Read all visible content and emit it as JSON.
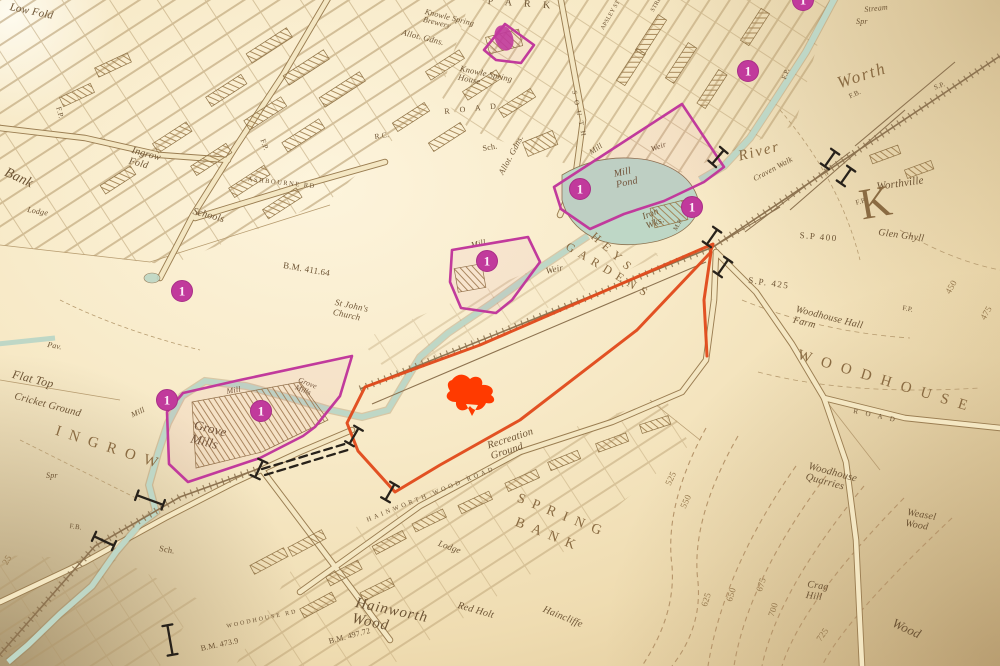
{
  "meta": {
    "description": "Photograph of a vintage Ordnance Survey town plan (Ingrow / Spring Bank area, Keighley) with hand-coloured plot annotations in magenta and an orange railway-land outline",
    "district_names": [
      "INGROW",
      "SPRING BANK",
      "WOODHOUSE",
      "HEYS GARDENS"
    ]
  },
  "palette": {
    "paper": "#f5e7c2",
    "ink": "#8d7350",
    "water": "#bed7c6",
    "magenta": "#c13a9c",
    "orange": "#e0491a",
    "red_splat": "#ff3a00",
    "black_ink": "#27211a"
  },
  "place_labels": [
    {
      "id": "low-fold",
      "text": "Low Fold",
      "x": 11,
      "y": 2,
      "rot": 12,
      "size": 11,
      "italic": true
    },
    {
      "id": "bank",
      "text": "Bank",
      "x": 8,
      "y": 166,
      "rot": 25,
      "size": 14,
      "italic": true
    },
    {
      "id": "lodge-west",
      "text": "Lodge",
      "x": 28,
      "y": 206,
      "rot": 10,
      "size": 8,
      "italic": true
    },
    {
      "id": "ingrow-fold",
      "text": "Ingrow\nFold",
      "x": 133,
      "y": 146,
      "rot": 15,
      "size": 10,
      "italic": true
    },
    {
      "id": "schools",
      "text": "Schools",
      "x": 194,
      "y": 207,
      "rot": 15,
      "size": 10,
      "italic": true
    },
    {
      "id": "ashbourne-road",
      "text": "ASHBOURNE RD",
      "x": 248,
      "y": 177,
      "rot": 6,
      "size": 6.5,
      "spacing": 1.5
    },
    {
      "id": "benchmark-1",
      "text": "B.M. 411.64",
      "x": 284,
      "y": 261,
      "rot": 10,
      "size": 9
    },
    {
      "id": "st-johns-church",
      "text": "St John's\nChurch",
      "x": 336,
      "y": 298,
      "rot": 12,
      "size": 9,
      "italic": true
    },
    {
      "id": "rc-school",
      "text": "R.C.",
      "x": 374,
      "y": 133,
      "rot": -8,
      "size": 7.5
    },
    {
      "id": "road-letters-1",
      "text": "R O A D",
      "x": 444,
      "y": 108,
      "rot": -6,
      "size": 8,
      "spacing": 4
    },
    {
      "id": "south-street",
      "text": "S O U T H",
      "x": 577,
      "y": 90,
      "rot": 78,
      "size": 7,
      "spacing": 2
    },
    {
      "id": "park-partial",
      "text": "P A R K",
      "x": 488,
      "y": -3,
      "rot": 4,
      "size": 10,
      "spacing": 5
    },
    {
      "id": "apsley-st",
      "text": "APSLEY ST",
      "x": 600,
      "y": 28,
      "rot": -60,
      "size": 6
    },
    {
      "id": "street-2",
      "text": "STREET",
      "x": 650,
      "y": 10,
      "rot": -60,
      "size": 6
    },
    {
      "id": "knowle-spring-brewery",
      "text": "Knowle Spring\nBrewery",
      "x": 426,
      "y": 8,
      "rot": 14,
      "size": 8,
      "italic": true
    },
    {
      "id": "knowle-spring-house",
      "text": "Knowle Spring\nHouse",
      "x": 461,
      "y": 64,
      "rot": 12,
      "size": 8.5,
      "italic": true
    },
    {
      "id": "allot-gdns-1",
      "text": "Allot. Gdns.",
      "x": 403,
      "y": 28,
      "rot": 14,
      "size": 8.5,
      "italic": true
    },
    {
      "id": "allot-gdns-2",
      "text": "Allot. Gdns.",
      "x": 497,
      "y": 172,
      "rot": -62,
      "size": 8.5,
      "italic": true
    },
    {
      "id": "sch-1",
      "text": "Sch.",
      "x": 482,
      "y": 145,
      "rot": -10,
      "size": 8
    },
    {
      "id": "river-name",
      "text": "River",
      "x": 737,
      "y": 150,
      "rot": -14,
      "size": 15,
      "italic": true,
      "spacing": 2,
      "color": "#8a6b42"
    },
    {
      "id": "worth-name",
      "text": "Worth",
      "x": 835,
      "y": 75,
      "rot": -18,
      "size": 17,
      "italic": true,
      "spacing": 2,
      "color": "#8a6b42"
    },
    {
      "id": "craven-walk",
      "text": "Craven Walk",
      "x": 752,
      "y": 176,
      "rot": -28,
      "size": 8,
      "italic": true
    },
    {
      "id": "stream",
      "text": "Stream",
      "x": 864,
      "y": 6,
      "rot": -6,
      "size": 8,
      "italic": true
    },
    {
      "id": "spr-2",
      "text": "Spr",
      "x": 856,
      "y": 18,
      "rot": 0,
      "size": 8,
      "italic": true
    },
    {
      "id": "fb-1",
      "text": "F.B.",
      "x": 848,
      "y": 94,
      "rot": -25,
      "size": 7
    },
    {
      "id": "fp-1",
      "text": "F.P.",
      "x": 781,
      "y": 78,
      "rot": -70,
      "size": 7
    },
    {
      "id": "sp-1",
      "text": "S.P.",
      "x": 933,
      "y": 85,
      "rot": -20,
      "size": 7
    },
    {
      "id": "fp-5",
      "text": "F.P.",
      "x": 855,
      "y": 200,
      "rot": -15,
      "size": 7
    },
    {
      "id": "worthville",
      "text": "Worthville",
      "x": 876,
      "y": 182,
      "rot": -8,
      "size": 11,
      "italic": true
    },
    {
      "id": "glen-ghyll",
      "text": "Glen Ghyll",
      "x": 879,
      "y": 228,
      "rot": 8,
      "size": 10,
      "italic": true
    },
    {
      "id": "sp400",
      "text": "S.P 400",
      "x": 800,
      "y": 231,
      "rot": 5,
      "size": 9,
      "spacing": 1.5
    },
    {
      "id": "sp425",
      "text": "S.P. 425",
      "x": 749,
      "y": 276,
      "rot": 8,
      "size": 9,
      "spacing": 1.5
    },
    {
      "id": "k-letter",
      "text": "K",
      "x": 856,
      "y": 183,
      "rot": -10,
      "size": 44,
      "color": "#8a6b42"
    },
    {
      "id": "woodhouse-hall-farm",
      "text": "Woodhouse Hall\nFarm",
      "x": 797,
      "y": 305,
      "rot": 14,
      "size": 10,
      "italic": true
    },
    {
      "id": "n450",
      "text": "450",
      "x": 944,
      "y": 291,
      "rot": -60,
      "size": 9,
      "color": "#96794e"
    },
    {
      "id": "n475",
      "text": "475",
      "x": 979,
      "y": 317,
      "rot": -60,
      "size": 9,
      "color": "#96794e"
    },
    {
      "id": "fp-2",
      "text": "F.P.",
      "x": 903,
      "y": 305,
      "rot": 10,
      "size": 7
    },
    {
      "id": "woodhouse-district",
      "text": "WOODHOUSE",
      "x": 800,
      "y": 348,
      "rot": 17,
      "size": 15,
      "spacing": 10,
      "color": "#8a6b42"
    },
    {
      "id": "heys",
      "text": "HEYS",
      "x": 597,
      "y": 230,
      "rot": 42,
      "size": 12,
      "spacing": 6,
      "color": "#8a6b42"
    },
    {
      "id": "gardens",
      "text": "GARDENS",
      "x": 570,
      "y": 240,
      "rot": 31,
      "size": 12,
      "spacing": 6,
      "color": "#8a6b42"
    },
    {
      "id": "mill-pond",
      "text": "Mill\nPond",
      "x": 613,
      "y": 170,
      "rot": -12,
      "size": 10,
      "italic": true
    },
    {
      "id": "iron-works",
      "text": "Iron\nWks.",
      "x": 641,
      "y": 213,
      "rot": -22,
      "size": 9.5,
      "italic": true
    },
    {
      "id": "mp",
      "text": "M.P.",
      "x": 673,
      "y": 229,
      "rot": -60,
      "size": 6.5
    },
    {
      "id": "weir-1",
      "text": "Weir",
      "x": 650,
      "y": 146,
      "rot": -20,
      "size": 8,
      "italic": true
    },
    {
      "id": "weir-2",
      "text": "Weir",
      "x": 545,
      "y": 267,
      "rot": -12,
      "size": 9,
      "italic": true
    },
    {
      "id": "mill-race",
      "text": "Mill",
      "x": 588,
      "y": 150,
      "rot": -35,
      "size": 8,
      "italic": true
    },
    {
      "id": "mill-c",
      "text": "Mill",
      "x": 470,
      "y": 241,
      "rot": -12,
      "size": 8.5,
      "italic": true
    },
    {
      "id": "fp-3",
      "text": "F.P.",
      "x": 62,
      "y": 106,
      "rot": 75,
      "size": 7.5
    },
    {
      "id": "fp-4",
      "text": "F.P.",
      "x": 266,
      "y": 138,
      "rot": 70,
      "size": 7.5
    },
    {
      "id": "flat-top",
      "text": "Flat Top",
      "x": 14,
      "y": 368,
      "rot": 14,
      "size": 12,
      "italic": true
    },
    {
      "id": "cricket-ground",
      "text": "Cricket Ground",
      "x": 16,
      "y": 391,
      "rot": 15,
      "size": 10.5,
      "italic": true
    },
    {
      "id": "pav",
      "text": "Pav.",
      "x": 48,
      "y": 341,
      "rot": 10,
      "size": 8,
      "italic": true
    },
    {
      "id": "ingrow-district",
      "text": "INGROW",
      "x": 58,
      "y": 424,
      "rot": 18,
      "size": 15,
      "spacing": 9,
      "color": "#8a6b42"
    },
    {
      "id": "spr-1",
      "text": "Spr",
      "x": 46,
      "y": 472,
      "rot": 0,
      "size": 8,
      "italic": true
    },
    {
      "id": "grove-mills",
      "text": "Grove\nMills",
      "x": 196,
      "y": 418,
      "rot": 14,
      "size": 13,
      "italic": true
    },
    {
      "id": "grove-mills-2",
      "text": "Grove\nMills",
      "x": 300,
      "y": 376,
      "rot": 22,
      "size": 7.5,
      "italic": true
    },
    {
      "id": "mill-d",
      "text": "Mill",
      "x": 226,
      "y": 388,
      "rot": -10,
      "size": 8,
      "italic": true
    },
    {
      "id": "mill-e",
      "text": "Mill",
      "x": 130,
      "y": 412,
      "rot": -25,
      "size": 8,
      "italic": true
    },
    {
      "id": "benchmark-2",
      "text": "B.M. 497.72",
      "x": 328,
      "y": 638,
      "rot": -15,
      "size": 8
    },
    {
      "id": "benchmark-3",
      "text": "B.M. 473.9",
      "x": 200,
      "y": 645,
      "rot": -12,
      "size": 8
    },
    {
      "id": "woodhouse-rd",
      "text": "WOODHOUSE RD",
      "x": 226,
      "y": 624,
      "rot": -12,
      "size": 6,
      "spacing": 2
    },
    {
      "id": "recreation-ground",
      "text": "Recreation\nGround",
      "x": 486,
      "y": 441,
      "rot": -18,
      "size": 10.5,
      "italic": true
    },
    {
      "id": "spring",
      "text": "SPRING",
      "x": 520,
      "y": 492,
      "rot": 22,
      "size": 14,
      "spacing": 8,
      "color": "#8a6b42"
    },
    {
      "id": "bank-2",
      "text": "BANK",
      "x": 518,
      "y": 516,
      "rot": 22,
      "size": 14,
      "spacing": 8,
      "color": "#8a6b42"
    },
    {
      "id": "hainworth-wood-road",
      "text": "HAINWORTH WOOD ROAD",
      "x": 366,
      "y": 518,
      "rot": -22,
      "size": 6.5,
      "spacing": 3
    },
    {
      "id": "lodge-south",
      "text": "Lodge",
      "x": 440,
      "y": 539,
      "rot": 20,
      "size": 9,
      "italic": true
    },
    {
      "id": "hainworth-wood",
      "text": "Hainworth\nWood",
      "x": 357,
      "y": 596,
      "rot": 12,
      "size": 15,
      "italic": true,
      "spacing": 1
    },
    {
      "id": "red-holt",
      "text": "Red Holt",
      "x": 459,
      "y": 601,
      "rot": 16,
      "size": 10,
      "italic": true
    },
    {
      "id": "haincliffe",
      "text": "Haincliffe",
      "x": 545,
      "y": 605,
      "rot": 22,
      "size": 10,
      "italic": true
    },
    {
      "id": "woodhouse-quarries",
      "text": "Woodhouse\nQuarries",
      "x": 810,
      "y": 461,
      "rot": 15,
      "size": 10.5,
      "italic": true
    },
    {
      "id": "weasel-wood",
      "text": "Weasel\nWood",
      "x": 908,
      "y": 508,
      "rot": 10,
      "size": 10,
      "italic": true
    },
    {
      "id": "crag-hill",
      "text": "Crag\nHill",
      "x": 808,
      "y": 580,
      "rot": 8,
      "size": 10,
      "italic": true
    },
    {
      "id": "wood-partial",
      "text": "Wood",
      "x": 896,
      "y": 616,
      "rot": 25,
      "size": 13,
      "italic": true
    },
    {
      "id": "road-letters-2",
      "text": "R O A D",
      "x": 854,
      "y": 408,
      "rot": 12,
      "size": 7,
      "spacing": 3
    },
    {
      "id": "contour-525",
      "text": "525",
      "x": 664,
      "y": 483,
      "rot": -65,
      "size": 9,
      "color": "#96794e"
    },
    {
      "id": "contour-550",
      "text": "550",
      "x": 679,
      "y": 506,
      "rot": -65,
      "size": 9,
      "color": "#96794e"
    },
    {
      "id": "contour-625",
      "text": "625",
      "x": 700,
      "y": 605,
      "rot": -72,
      "size": 9,
      "color": "#96794e"
    },
    {
      "id": "contour-650",
      "text": "650",
      "x": 725,
      "y": 600,
      "rot": -72,
      "size": 9,
      "color": "#96794e"
    },
    {
      "id": "contour-675",
      "text": "675",
      "x": 755,
      "y": 590,
      "rot": -72,
      "size": 9,
      "color": "#96794e"
    },
    {
      "id": "contour-700",
      "text": "700",
      "x": 767,
      "y": 615,
      "rot": -72,
      "size": 9,
      "color": "#96794e"
    },
    {
      "id": "contour-725",
      "text": "725",
      "x": 815,
      "y": 638,
      "rot": -55,
      "size": 9,
      "color": "#96794e"
    },
    {
      "id": "contour-425-partial",
      "text": "25",
      "x": 1,
      "y": 562,
      "rot": -60,
      "size": 9,
      "color": "#96794e"
    },
    {
      "id": "fb-2",
      "text": "F.B.",
      "x": 70,
      "y": 523,
      "rot": 8,
      "size": 7
    },
    {
      "id": "sch-2",
      "text": "Sch.",
      "x": 160,
      "y": 544,
      "rot": 10,
      "size": 8.5
    }
  ],
  "markers": {
    "circles": [
      {
        "glyph": "1",
        "x": 748,
        "y": 71
      },
      {
        "glyph": "1",
        "x": 580,
        "y": 189
      },
      {
        "glyph": "1",
        "x": 692,
        "y": 207
      },
      {
        "glyph": "1",
        "x": 487,
        "y": 261
      },
      {
        "glyph": "1",
        "x": 182,
        "y": 291
      },
      {
        "glyph": "1",
        "x": 167,
        "y": 400
      },
      {
        "glyph": "1",
        "x": 261,
        "y": 411
      },
      {
        "glyph": "1",
        "x": 803,
        "y": 0
      }
    ],
    "blob": {
      "x": 504,
      "y": 38,
      "rx": 9,
      "ry": 13,
      "rot": -20
    },
    "red_splat": {
      "path": "M452,380 C458,372 466,374 470,379 C476,374 484,378 482,385 C490,384 496,390 491,395 C497,399 494,405 486,403 C483,410 475,413 470,406 C464,414 455,410 456,402 C448,402 443,396 450,391 C446,385 448,381 452,380 Z M466,404 L472,416 L478,405 Z"
    }
  },
  "annotations": {
    "magenta_polygons": [
      {
        "name": "plot-brewery",
        "points": "484,50 505,24 534,45 521,63 496,60"
      },
      {
        "name": "plot-worth-mill",
        "points": "682,104 724,167 704,182 664,201 624,214 590,229 561,209 554,187"
      },
      {
        "name": "plot-heys-mill",
        "points": "452,250 528,237 540,262 512,300 496,313 461,308 450,282"
      },
      {
        "name": "plot-grove-mills",
        "points": "352,356 340,396 315,427 303,436 260,458 188,482 169,464 167,412 183,393 240,380"
      }
    ],
    "orange_route": {
      "name": "railway-land-outline",
      "points": "713,244 480,345 365,387 347,423 358,451 395,492 440,465 520,420 637,330 710,253",
      "spur": "711,252 704,300 707,356"
    },
    "black_dashed_links": [
      {
        "x1": 262,
        "y1": 469,
        "x2": 348,
        "y2": 443
      },
      {
        "x1": 265,
        "y1": 475,
        "x2": 351,
        "y2": 449
      }
    ],
    "black_marks": [
      {
        "x": 712,
        "y": 237,
        "rot": -55
      },
      {
        "x": 723,
        "y": 267,
        "rot": -55
      },
      {
        "x": 830,
        "y": 159,
        "rot": -55
      },
      {
        "x": 846,
        "y": 176,
        "rot": -55
      },
      {
        "x": 718,
        "y": 157,
        "rot": -50
      },
      {
        "x": 354,
        "y": 436,
        "rot": -60
      },
      {
        "x": 390,
        "y": 492,
        "rot": -60
      },
      {
        "x": 259,
        "y": 469,
        "rot": -65
      },
      {
        "x": 150,
        "y": 500,
        "rot": 20,
        "len": 14
      },
      {
        "x": 104,
        "y": 541,
        "rot": 25,
        "len": 11
      },
      {
        "x": 170,
        "y": 640,
        "rot": 80,
        "len": 15
      }
    ]
  }
}
